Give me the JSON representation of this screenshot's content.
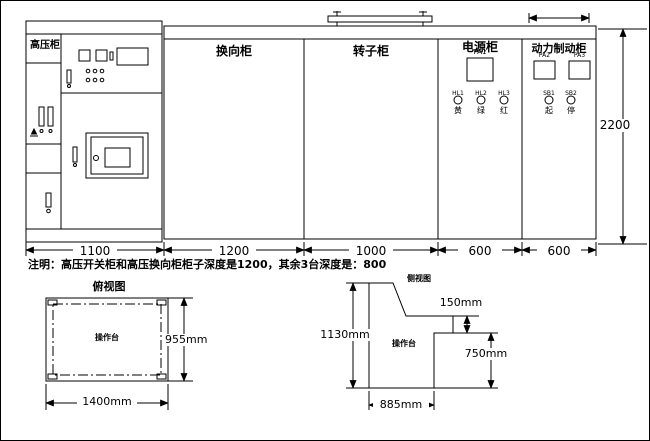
{
  "drawing": {
    "front_view": {
      "cabinets": [
        {
          "label": "高压柜"
        },
        {
          "label": "换向柜"
        },
        {
          "label": "转子柜"
        },
        {
          "label": "电源柜"
        },
        {
          "label": "动力制动柜"
        }
      ],
      "power_cabinet": {
        "meter_label": "PA1",
        "lamps": [
          {
            "tag": "HL1",
            "char": "黄"
          },
          {
            "tag": "HL2",
            "char": "绿"
          },
          {
            "tag": "HL3",
            "char": "红"
          }
        ]
      },
      "brake_cabinet": {
        "meter_labels": [
          "PA2",
          "PA3"
        ],
        "buttons": [
          {
            "tag": "SB1",
            "char": "起"
          },
          {
            "tag": "SB2",
            "char": "停"
          }
        ]
      },
      "width_dims": [
        "1100",
        "1200",
        "1000",
        "600",
        "600"
      ],
      "height_dim": "2200"
    },
    "note": "注明：高压开关柜和高压换向柜柜子深度是1200，其余3台深度是：800",
    "top_view": {
      "title": "俯视图",
      "label": "操作台",
      "depth_dim": "955mm",
      "width_dim": "1400mm"
    },
    "side_view": {
      "title": "侧视图",
      "label": "操作台",
      "height_dim": "1130mm",
      "step_dim": "150mm",
      "front_dim": "750mm",
      "base_dim": "885mm"
    },
    "colors": {
      "line": "#000000",
      "background": "#ffffff"
    }
  }
}
